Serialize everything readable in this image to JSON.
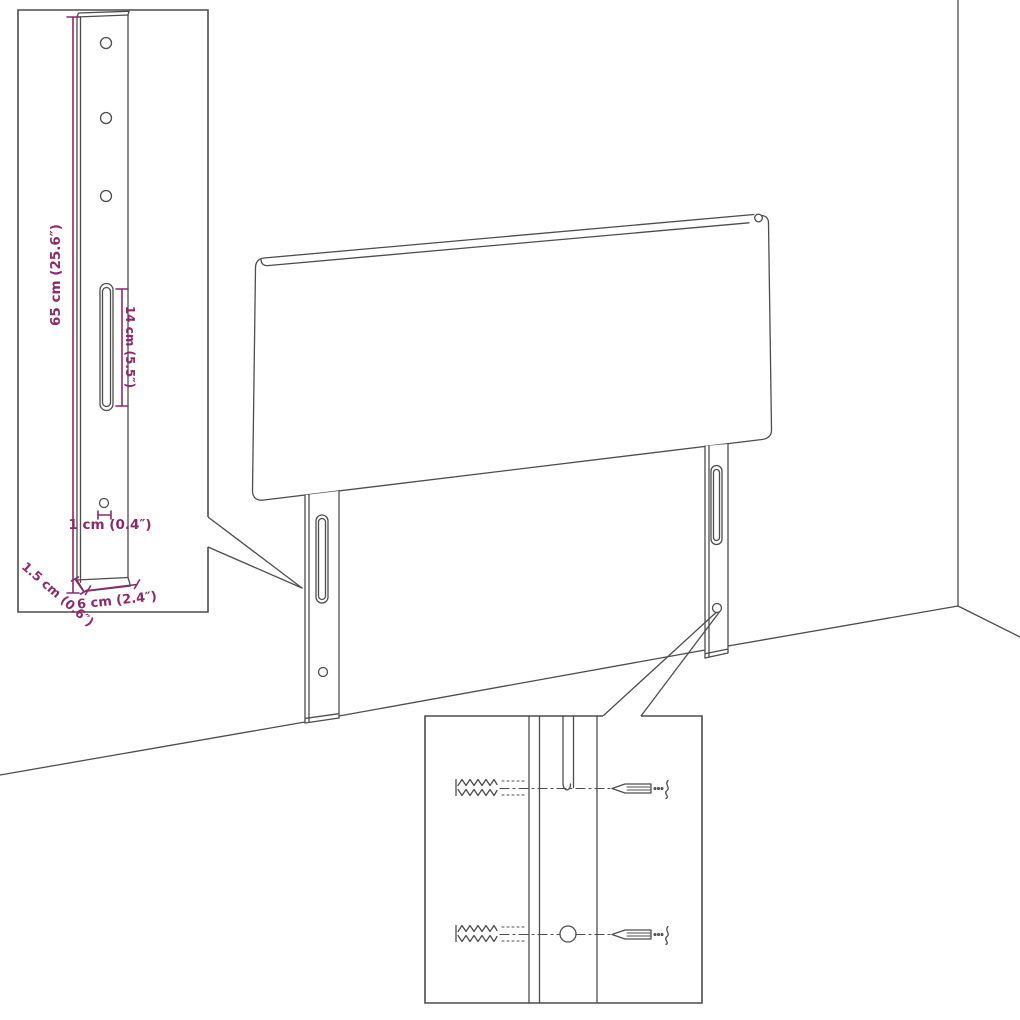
{
  "colors": {
    "background": "#ffffff",
    "line": "#4d4d4d",
    "dimension_text": "#8a2a6b"
  },
  "leg_detail_labels": {
    "height": "65 cm (25.6″)",
    "slot": "14 cm (5.5″)",
    "hole": "1 cm (0.4″)",
    "thickness": "1.5 cm (0.6″)",
    "width": "6 cm (2.4″)"
  }
}
